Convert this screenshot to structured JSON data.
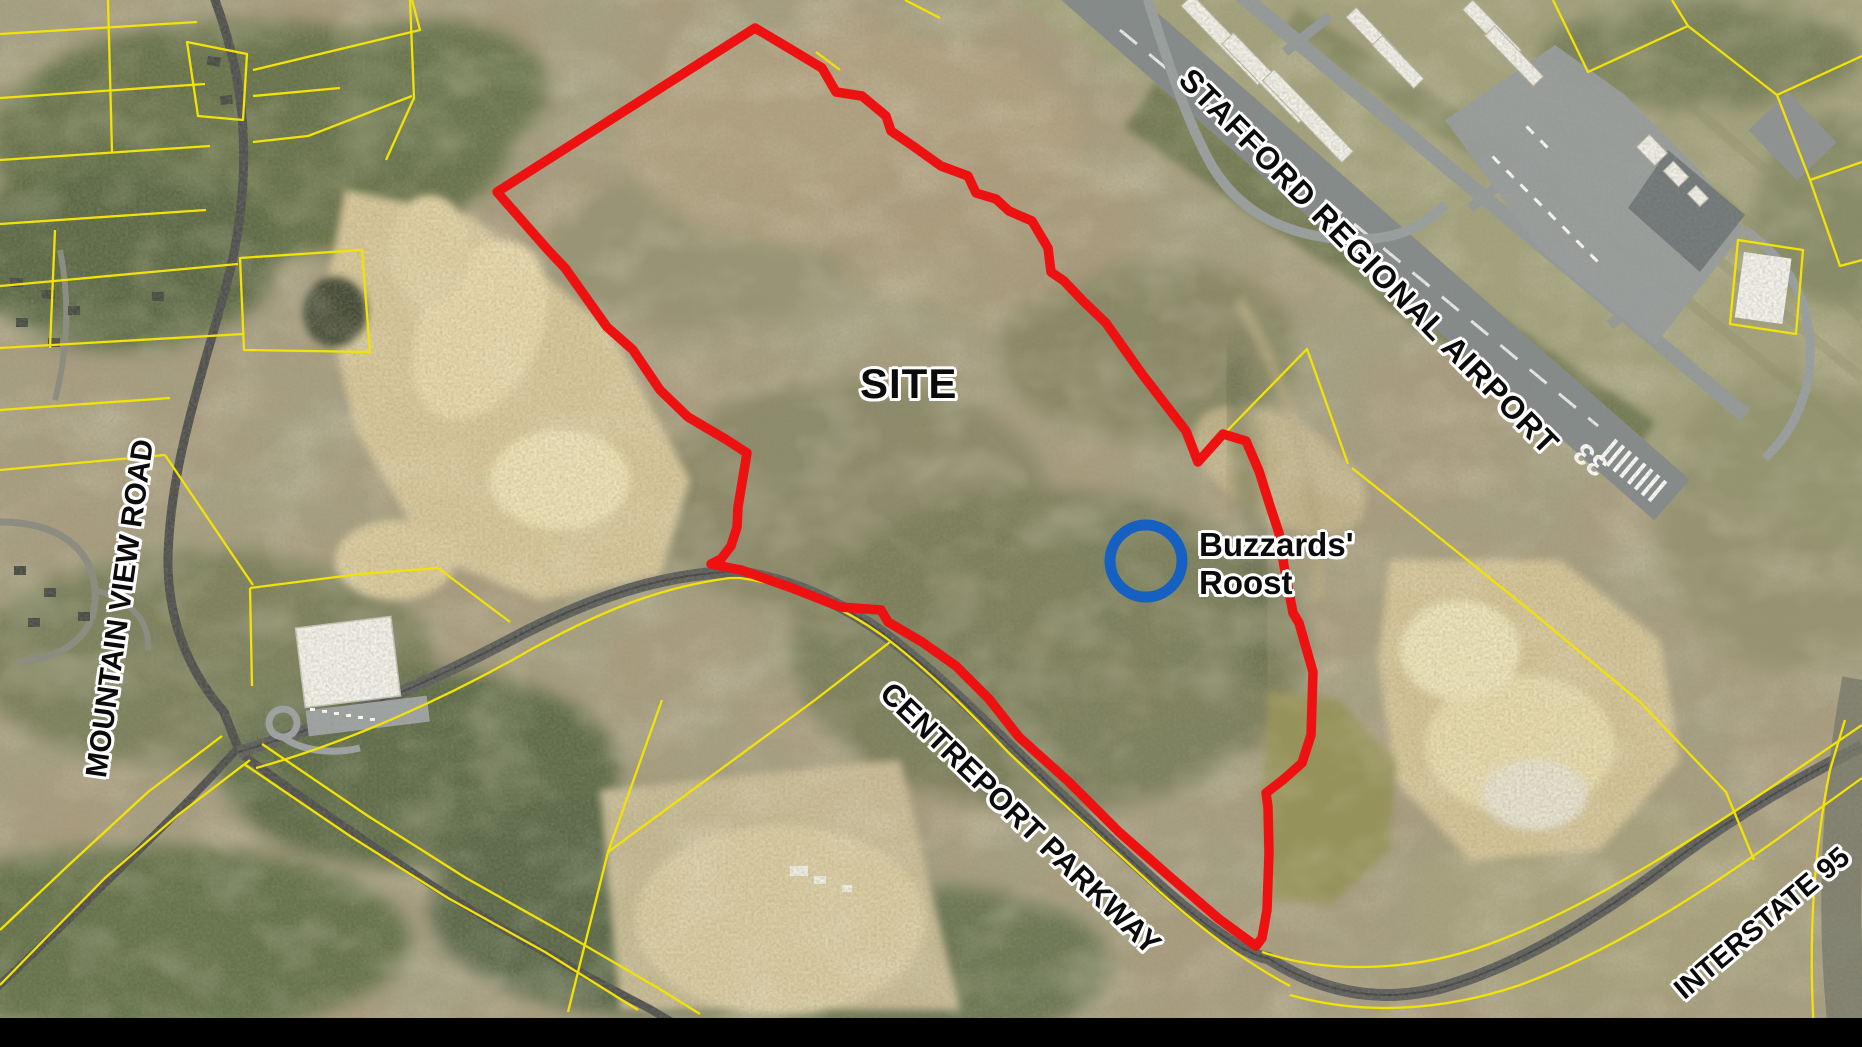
{
  "map": {
    "title": "Aerial site map",
    "labels": {
      "site": "SITE",
      "buzzards_line1": "Buzzards'",
      "buzzards_line2": "Roost",
      "airport": "STAFFORD REGIONAL AIRPORT",
      "mountain_view": "MOUNTAIN VIEW ROAD",
      "centreport": "CENTREPORT PARKWAY",
      "interstate": "INTERSTATE 95",
      "runway_number": "33"
    },
    "colors": {
      "site_boundary": "#ee1111",
      "parcel_lines": "#f2e205",
      "poi_circle": "#1560c0",
      "label_text": "#0b0b0b",
      "label_outline": "#ffffff"
    }
  }
}
